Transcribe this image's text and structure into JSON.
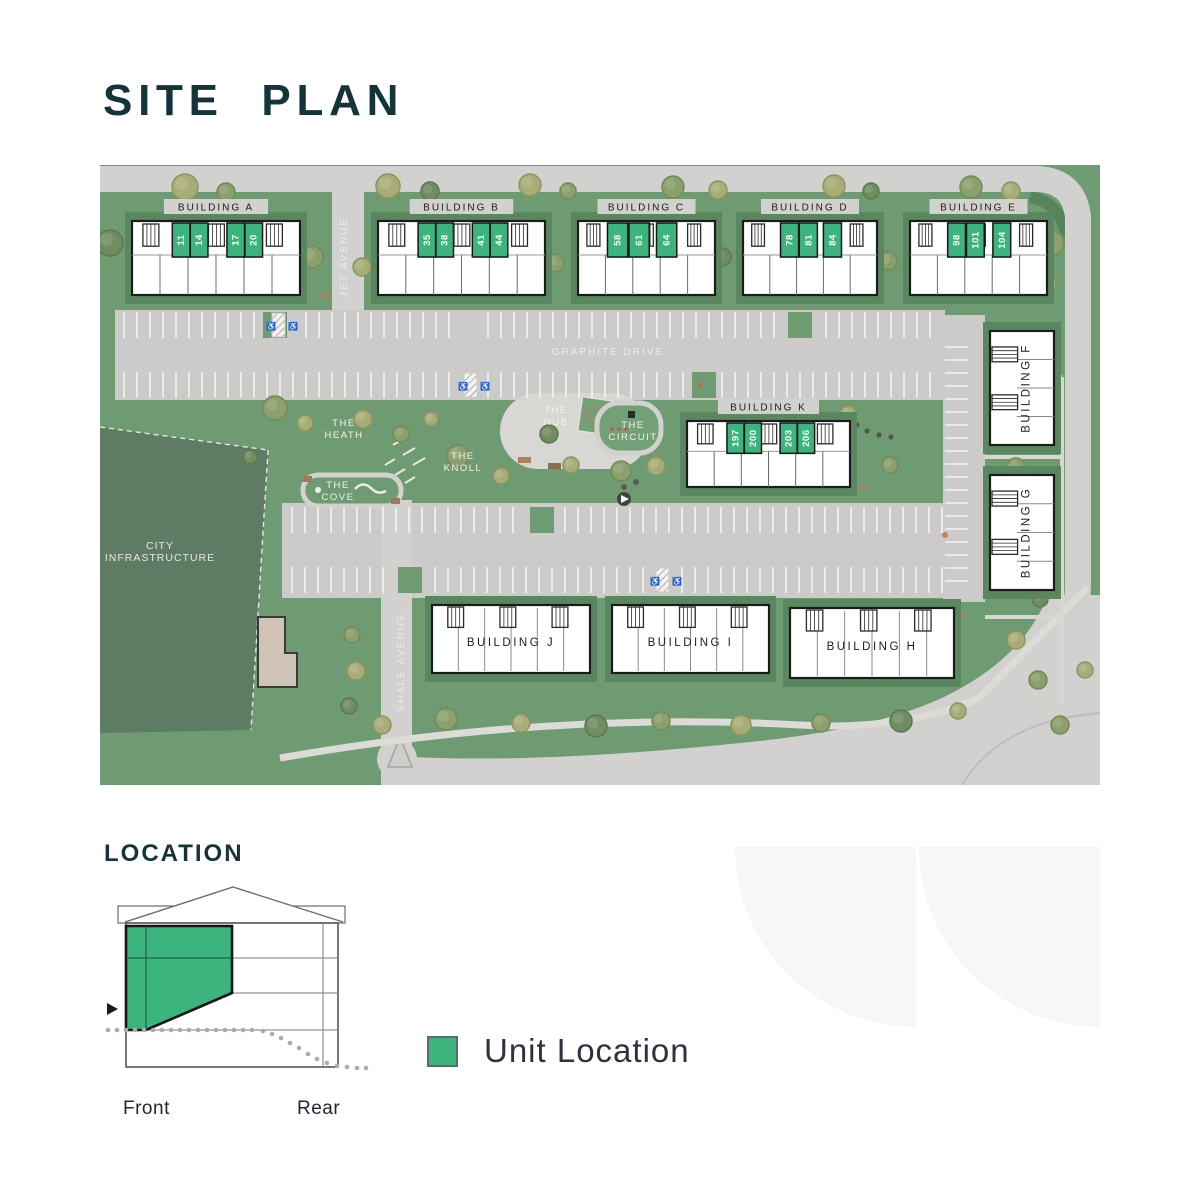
{
  "page": {
    "title": "SITE PLAN",
    "location_heading": "LOCATION"
  },
  "theme": {
    "accent_green": "#3CB47E",
    "heading_teal": "#14343A",
    "lawn_green": "#6F9B72",
    "road_gray": "#D2D1CF",
    "dark_green_area": "#5E7C63"
  },
  "legend": {
    "label": "Unit Location",
    "swatch_color": "#3CB47E"
  },
  "location_diagram": {
    "front_label": "Front",
    "rear_label": "Rear"
  },
  "site_plan": {
    "streets": [
      {
        "id": "jet-avenue",
        "name": "JET AVENUE",
        "x": 247,
        "y": 92,
        "rotate": -90
      },
      {
        "id": "graphite-drive",
        "name": "GRAPHITE DRIVE",
        "x": 508,
        "y": 190,
        "rotate": 0
      },
      {
        "id": "shale-avenue",
        "name": "SHALE AVENUE",
        "x": 304,
        "y": 497,
        "rotate": -90
      }
    ],
    "areas": [
      {
        "id": "the-heath",
        "lines": [
          "THE",
          "HEATH"
        ],
        "x": 244,
        "y": 261
      },
      {
        "id": "the-hub",
        "lines": [
          "THE",
          "HUB"
        ],
        "x": 456,
        "y": 248
      },
      {
        "id": "the-circuit",
        "lines": [
          "THE",
          "CIRCUIT"
        ],
        "x": 533,
        "y": 263
      },
      {
        "id": "the-knoll",
        "lines": [
          "THE",
          "KNOLL"
        ],
        "x": 363,
        "y": 294
      },
      {
        "id": "the-cove",
        "lines": [
          "THE",
          "COVE"
        ],
        "x": 238,
        "y": 323
      },
      {
        "id": "city-infrastructure",
        "lines": [
          "CITY",
          "INFRASTRUCTURE"
        ],
        "x": 60,
        "y": 384
      }
    ],
    "buildings": [
      {
        "id": "A",
        "label": "BUILDING A",
        "kind": "row-top",
        "plate": true,
        "x": 32,
        "y": 56,
        "w": 168,
        "h": 74,
        "cells": 6,
        "green_w": 0.105,
        "green_units": [
          {
            "number": "11",
            "fx": 0.24
          },
          {
            "number": "14",
            "fx": 0.347
          },
          {
            "number": "17",
            "fx": 0.565
          },
          {
            "number": "20",
            "fx": 0.672
          }
        ]
      },
      {
        "id": "B",
        "label": "BUILDING B",
        "kind": "row-top",
        "plate": true,
        "x": 278,
        "y": 56,
        "w": 167,
        "h": 74,
        "cells": 6,
        "green_w": 0.105,
        "green_units": [
          {
            "number": "35",
            "fx": 0.24
          },
          {
            "number": "38",
            "fx": 0.347
          },
          {
            "number": "41",
            "fx": 0.565
          },
          {
            "number": "44",
            "fx": 0.672
          }
        ]
      },
      {
        "id": "C",
        "label": "BUILDING C",
        "kind": "row-top",
        "plate": true,
        "x": 478,
        "y": 56,
        "w": 137,
        "h": 74,
        "cells": 5,
        "green_w": 0.148,
        "green_units": [
          {
            "number": "58",
            "fx": 0.215
          },
          {
            "number": "61",
            "fx": 0.372
          },
          {
            "number": "64",
            "fx": 0.573
          }
        ]
      },
      {
        "id": "D",
        "label": "BUILDING D",
        "kind": "row-top",
        "plate": true,
        "x": 643,
        "y": 56,
        "w": 134,
        "h": 74,
        "cells": 5,
        "green_w": 0.135,
        "green_units": [
          {
            "number": "78",
            "fx": 0.28
          },
          {
            "number": "81",
            "fx": 0.42
          },
          {
            "number": "84",
            "fx": 0.6
          }
        ]
      },
      {
        "id": "E",
        "label": "BUILDING E",
        "kind": "row-top",
        "plate": true,
        "x": 810,
        "y": 56,
        "w": 137,
        "h": 74,
        "cells": 5,
        "green_w": 0.13,
        "green_units": [
          {
            "number": "98",
            "fx": 0.275
          },
          {
            "number": "101",
            "fx": 0.412
          },
          {
            "number": "104",
            "fx": 0.605
          }
        ]
      },
      {
        "id": "K",
        "label": "BUILDING K",
        "kind": "row-top",
        "plate": true,
        "x": 587,
        "y": 256,
        "w": 163,
        "h": 66,
        "cells": 6,
        "green_w": 0.105,
        "green_units": [
          {
            "number": "197",
            "fx": 0.245
          },
          {
            "number": "200",
            "fx": 0.352
          },
          {
            "number": "203",
            "fx": 0.571
          },
          {
            "number": "206",
            "fx": 0.678
          }
        ]
      },
      {
        "id": "F",
        "label": "BUILDING F",
        "kind": "tower",
        "x": 890,
        "y": 166,
        "w": 64,
        "h": 114,
        "cells": 4,
        "green_units": []
      },
      {
        "id": "G",
        "label": "BUILDING G",
        "kind": "tower",
        "x": 890,
        "y": 310,
        "w": 64,
        "h": 115,
        "cells": 4,
        "green_units": []
      },
      {
        "id": "J",
        "label": "BUILDING J",
        "kind": "row-bottom",
        "x": 332,
        "y": 440,
        "w": 158,
        "h": 68,
        "cells": 6,
        "green_units": []
      },
      {
        "id": "I",
        "label": "BUILDING I",
        "kind": "row-bottom",
        "x": 512,
        "y": 440,
        "w": 157,
        "h": 68,
        "cells": 6,
        "green_units": []
      },
      {
        "id": "H",
        "label": "BUILDING H",
        "kind": "row-bottom",
        "x": 690,
        "y": 443,
        "w": 164,
        "h": 70,
        "cells": 6,
        "green_units": []
      }
    ]
  }
}
